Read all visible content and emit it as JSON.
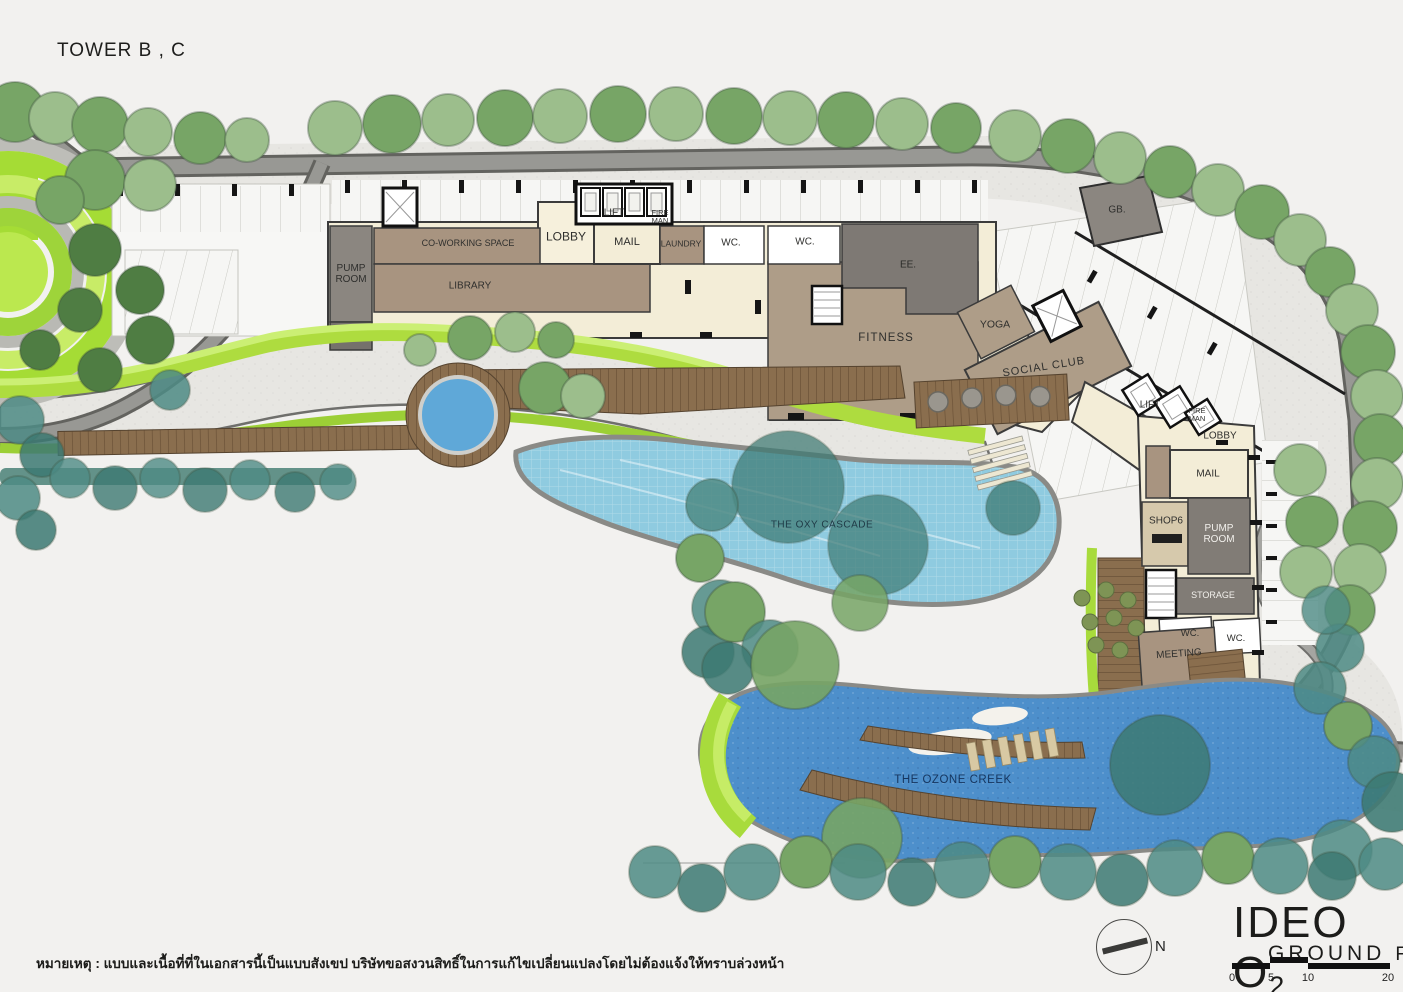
{
  "title": "TOWER B , C",
  "palette": {
    "background": "#F2F1EF",
    "building_cream": "#F3EDD7",
    "room_brown": "#A89480",
    "room_gray": "#8B8680",
    "room_dark_gray": "#7E7974",
    "pool_upper": "#8FCBE0",
    "pool_creek": "#4D8FCB",
    "lawn_lime": "#A8DB3C",
    "tree_teal": "#4E8B85",
    "road_gray": "#97979",
    "deck_wood": "#8A6E4E"
  },
  "rooms": {
    "pump_room_b": "PUMP ROOM",
    "co_working": "CO-WORKING SPACE",
    "library": "LIBRARY",
    "lobby_b": "LOBBY",
    "lift_b": "LIFT",
    "fireman_b": "FIRE MAN",
    "mail_b": "MAIL",
    "laundry": "LAUNDRY",
    "wc_1": "WC.",
    "wc_2": "WC.",
    "ee": "EE.",
    "fitness": "FITNESS",
    "yoga": "YOGA",
    "social_club": "SOCIAL CLUB",
    "gb": "GB.",
    "lift_c": "LIFT",
    "fireman_c": "FIRE MAN",
    "lobby_c": "LOBBY",
    "mail_c": "MAIL",
    "shop6": "SHOP6",
    "pump_room_c": "PUMP ROOM",
    "storage": "STORAGE",
    "wc_3": "WC.",
    "wc_4": "WC.",
    "meeting": "MEETING"
  },
  "water": {
    "oxy_cascade": "THE OXY CASCADE",
    "ozone_creek": "THE OZONE CREEK"
  },
  "footer": {
    "note": "หมายเหตุ : แบบและเนื้อที่ที่ในเอกสารนี้เป็นแบบสังเขป บริษัทขอสงวนสิทธิ์ในการแก้ไขเปลี่ยนแปลงโดยไม่ต้องแจ้งให้ทราบล่วงหน้า",
    "brand": "IDEO O",
    "brand_sub": "2",
    "floor_label": "GROUND",
    "floor_word": "Floor",
    "compass_n": "N",
    "scale": {
      "ticks": [
        "0",
        "5",
        "10",
        "20"
      ]
    }
  }
}
